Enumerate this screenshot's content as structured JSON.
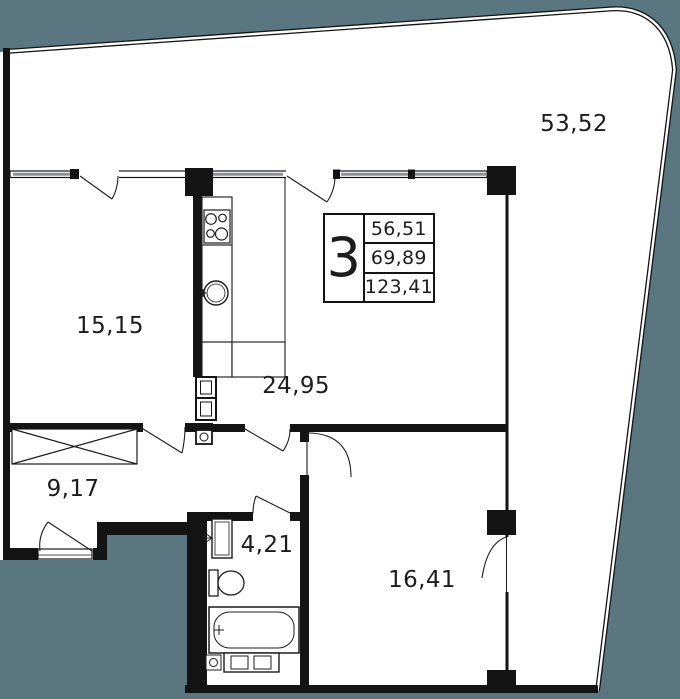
{
  "plan_title": "apartment-floor-plan",
  "badge": {
    "rooms": "3",
    "areas": [
      "56,51",
      "69,89",
      "123,41"
    ]
  },
  "rooms": [
    {
      "name": "terrace",
      "area": "53,52"
    },
    {
      "name": "bedroom",
      "area": "15,15"
    },
    {
      "name": "kitchen-living-room",
      "area": "24,95"
    },
    {
      "name": "hallway",
      "area": "9,17"
    },
    {
      "name": "bathroom",
      "area": "4,21"
    },
    {
      "name": "bedroom-2",
      "area": "16,41"
    }
  ],
  "colors": {
    "outside": "#5a7680",
    "paper": "#ffffff",
    "line": "#141414",
    "window": "#8d9094"
  },
  "icons": [
    "stove-icon",
    "kitchen-sink-icon",
    "vent-shaft-icon",
    "water-heater-icon",
    "wardrobe-icon",
    "bath-sink-icon",
    "toilet-icon",
    "bathtub-icon",
    "washing-machine-icon",
    "entrance-threshold-icon"
  ]
}
